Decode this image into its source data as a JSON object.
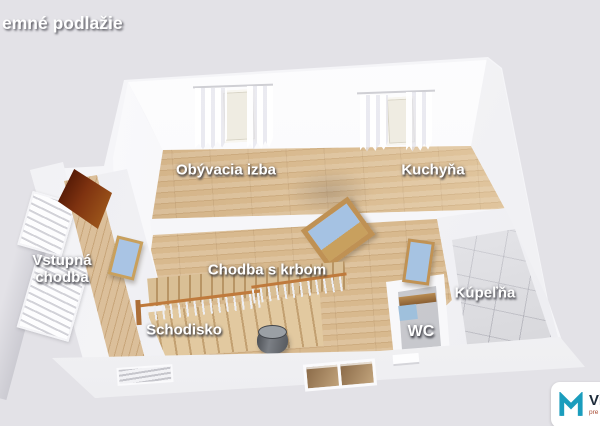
{
  "title": "emné podlažie",
  "rooms": {
    "living": {
      "label": "Obývacia izba"
    },
    "kitchen": {
      "label": "Kuchyňa"
    },
    "entrance": {
      "label": "Vstupná chodba",
      "line1": "Vstupná",
      "line2": "chodba"
    },
    "hall_fireplace": {
      "label": "Chodba s krbom"
    },
    "staircase": {
      "label": "Schodisko"
    },
    "wc": {
      "label": "WC"
    },
    "bathroom": {
      "label": "Kúpeľňa"
    }
  },
  "logo": {
    "text": "Viz",
    "subtext": "pre",
    "icon": "m-mark-icon",
    "accent_color": "#1b9dbd"
  },
  "colors": {
    "background": "#e3e2e7",
    "walls": "#f7f7f9",
    "wood_floor": "#d8b98e",
    "bathroom_tile": "#d9d9dd",
    "entrance_door": "#7e3210",
    "interior_door_wood": "#c19253",
    "interior_door_glass": "#a6c3e2",
    "stair_railing": "#bf7a3c",
    "stove": "#54575c"
  }
}
